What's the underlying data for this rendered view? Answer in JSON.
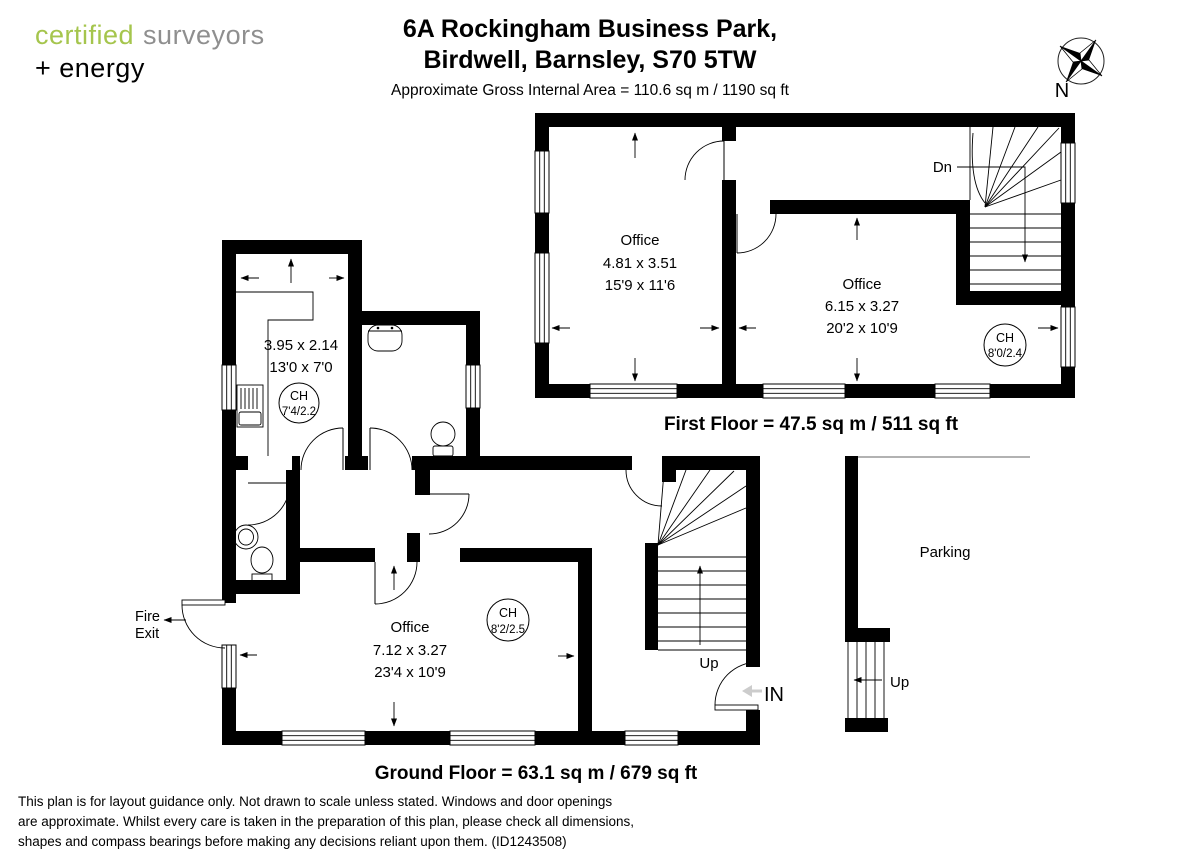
{
  "colors": {
    "brand_green": "#a5c54d",
    "brand_gray": "#8f8f8f",
    "ink": "#000000",
    "muted_arrow": "#cccccc"
  },
  "logo": {
    "word_green": "certified",
    "word_gray": "surveyors",
    "line2": "+ energy"
  },
  "header": {
    "address_line1": "6A Rockingham Business Park,",
    "address_line2": "Birdwell, Barnsley, S70 5TW",
    "area_line": "Approximate Gross Internal Area = 110.6 sq m / 1190 sq ft"
  },
  "compass": {
    "north_label": "N"
  },
  "first_floor": {
    "title": "First Floor = 47.5 sq m / 511 sq ft",
    "stairs_label": "Dn",
    "office_left": {
      "name": "Office",
      "metric": "4.81 x 3.51",
      "imperial": "15'9 x 11'6"
    },
    "office_right": {
      "name": "Office",
      "metric": "6.15 x 3.27",
      "imperial": "20'2 x 10'9"
    },
    "ceiling": {
      "label": "CH",
      "value": "8'0/2.4"
    }
  },
  "ground_floor": {
    "title": "Ground Floor =  63.1 sq m / 679 sq ft",
    "kitchen": {
      "metric": "3.95 x 2.14",
      "imperial": "13'0 x 7'0",
      "ceiling": {
        "label": "CH",
        "value": "7'4/2.2"
      }
    },
    "office": {
      "name": "Office",
      "metric": "7.12 x 3.27",
      "imperial": "23'4 x 10'9",
      "ceiling": {
        "label": "CH",
        "value": "8'2/2.5"
      }
    },
    "fire_exit_line1": "Fire",
    "fire_exit_line2": "Exit",
    "parking_label": "Parking",
    "stairs_up_label": "Up",
    "entrance_label": "IN",
    "external_steps_label": "Up"
  },
  "footer": {
    "line1": "This plan is for layout guidance only. Not drawn to scale unless stated. Windows and door openings",
    "line2": "are approximate. Whilst every care is taken in the preparation of this plan, please check all dimensions,",
    "line3": "shapes and compass bearings before making any decisions reliant upon them. (ID1243508)"
  }
}
